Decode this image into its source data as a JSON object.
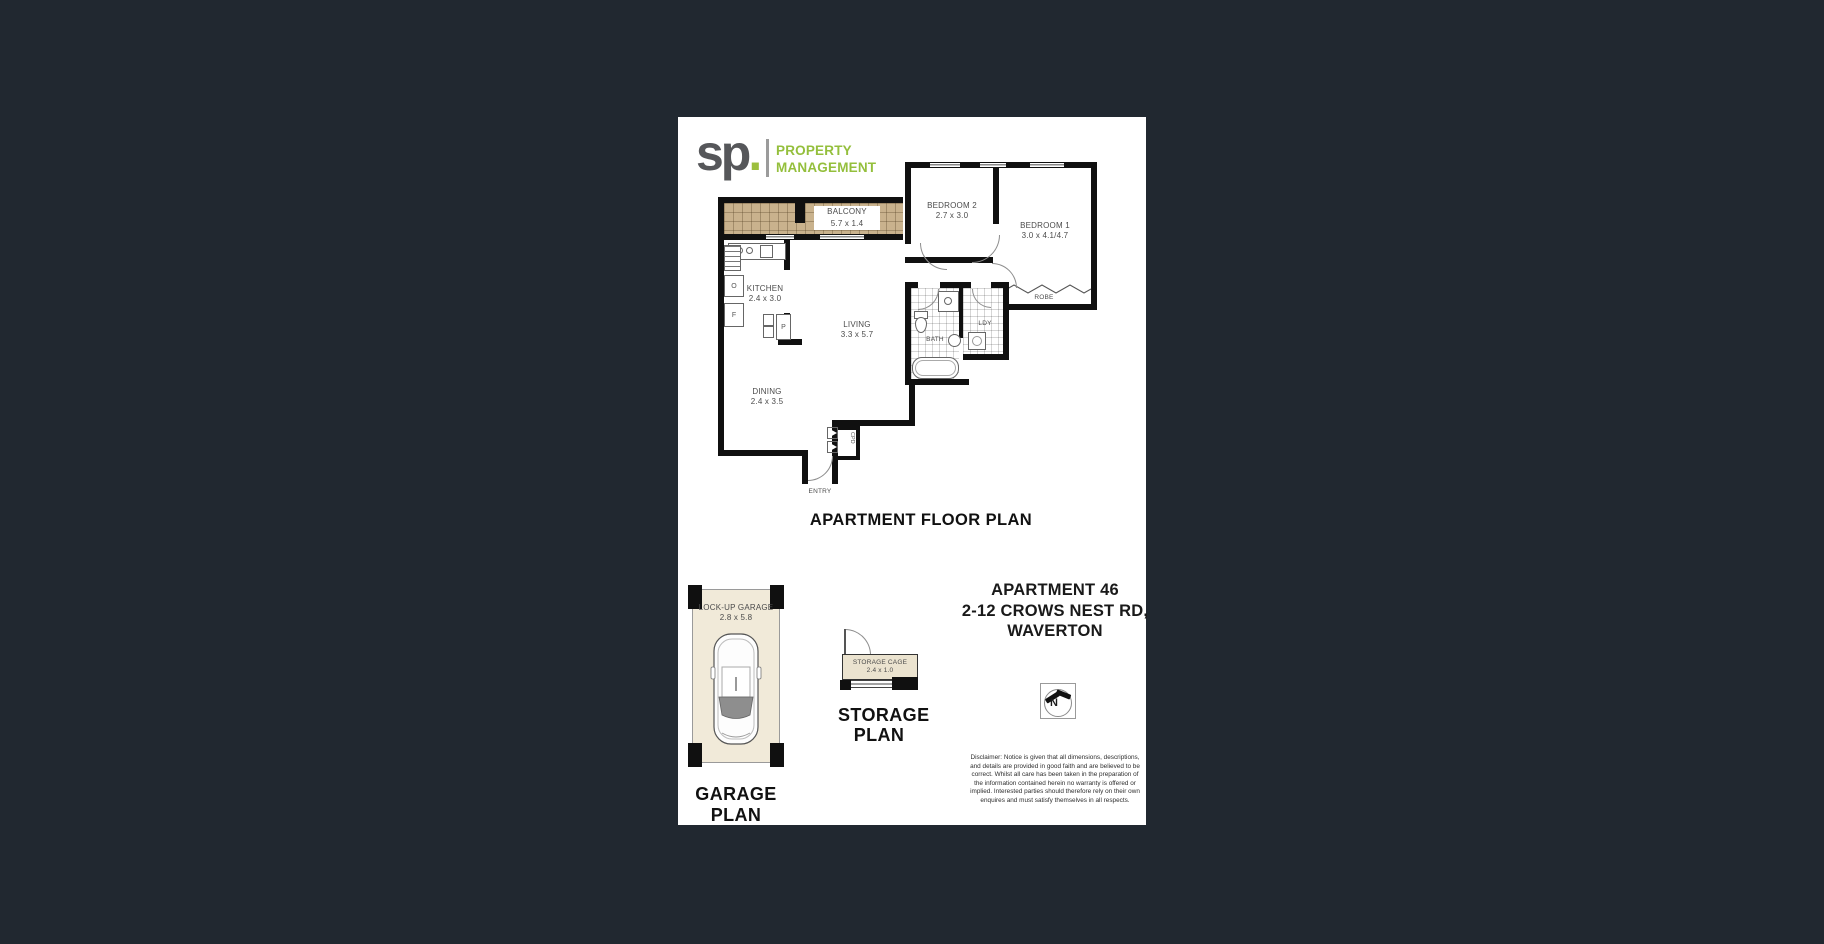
{
  "logo": {
    "sp": "sp",
    "dot": ".",
    "line1": "PROPERTY",
    "line2": "MANAGEMENT"
  },
  "floorplan": {
    "title": "APARTMENT FLOOR PLAN",
    "balcony_name": "BALCONY",
    "balcony_dims": "5.7 x 1.4",
    "bedroom2_name": "BEDROOM 2",
    "bedroom2_dims": "2.7 x 3.0",
    "bedroom1_name": "BEDROOM 1",
    "bedroom1_dims": "3.0 x 4.1/4.7",
    "kitchen_name": "KITCHEN",
    "kitchen_dims": "2.4 x 3.0",
    "living_name": "LIVING",
    "living_dims": "3.3 x 5.7",
    "dining_name": "DINING",
    "dining_dims": "2.4 x 3.5",
    "bath": "BATH",
    "ldy": "LDY",
    "robe": "ROBE",
    "cpd": "CPD",
    "entry": "ENTRY",
    "oven": "O",
    "fridge": "F",
    "pantry": "P"
  },
  "garage": {
    "title": "GARAGE PLAN",
    "name": "LOCK-UP GARAGE",
    "dims": "2.8 x 5.8"
  },
  "storage": {
    "title1": "STORAGE",
    "title2": "PLAN",
    "name": "STORAGE CAGE",
    "dims": "2.4 x 1.0"
  },
  "address": {
    "line1": "APARTMENT 46",
    "line2": "2-12 CROWS NEST RD,",
    "line3": "WAVERTON"
  },
  "compass": {
    "n": "N"
  },
  "disclaimer": {
    "lines": [
      "Disclaimer: Notice is given that all dimensions, descriptions,",
      "and details are provided in good faith and are believed to be",
      "correct. Whilst all care has been taken in the preparation of",
      "the information contained herein no warranty is offered or",
      "implied. Interested parties should therefore rely on their own",
      "enquires and must satisfy themselves in all respects."
    ]
  },
  "colors": {
    "page_bg": "#212830",
    "sheet": "#ffffff",
    "brand_green": "#94bf3c",
    "balcony_tan": "#c9b28d",
    "garage_cream": "#f1ead9",
    "wall": "#101010"
  }
}
